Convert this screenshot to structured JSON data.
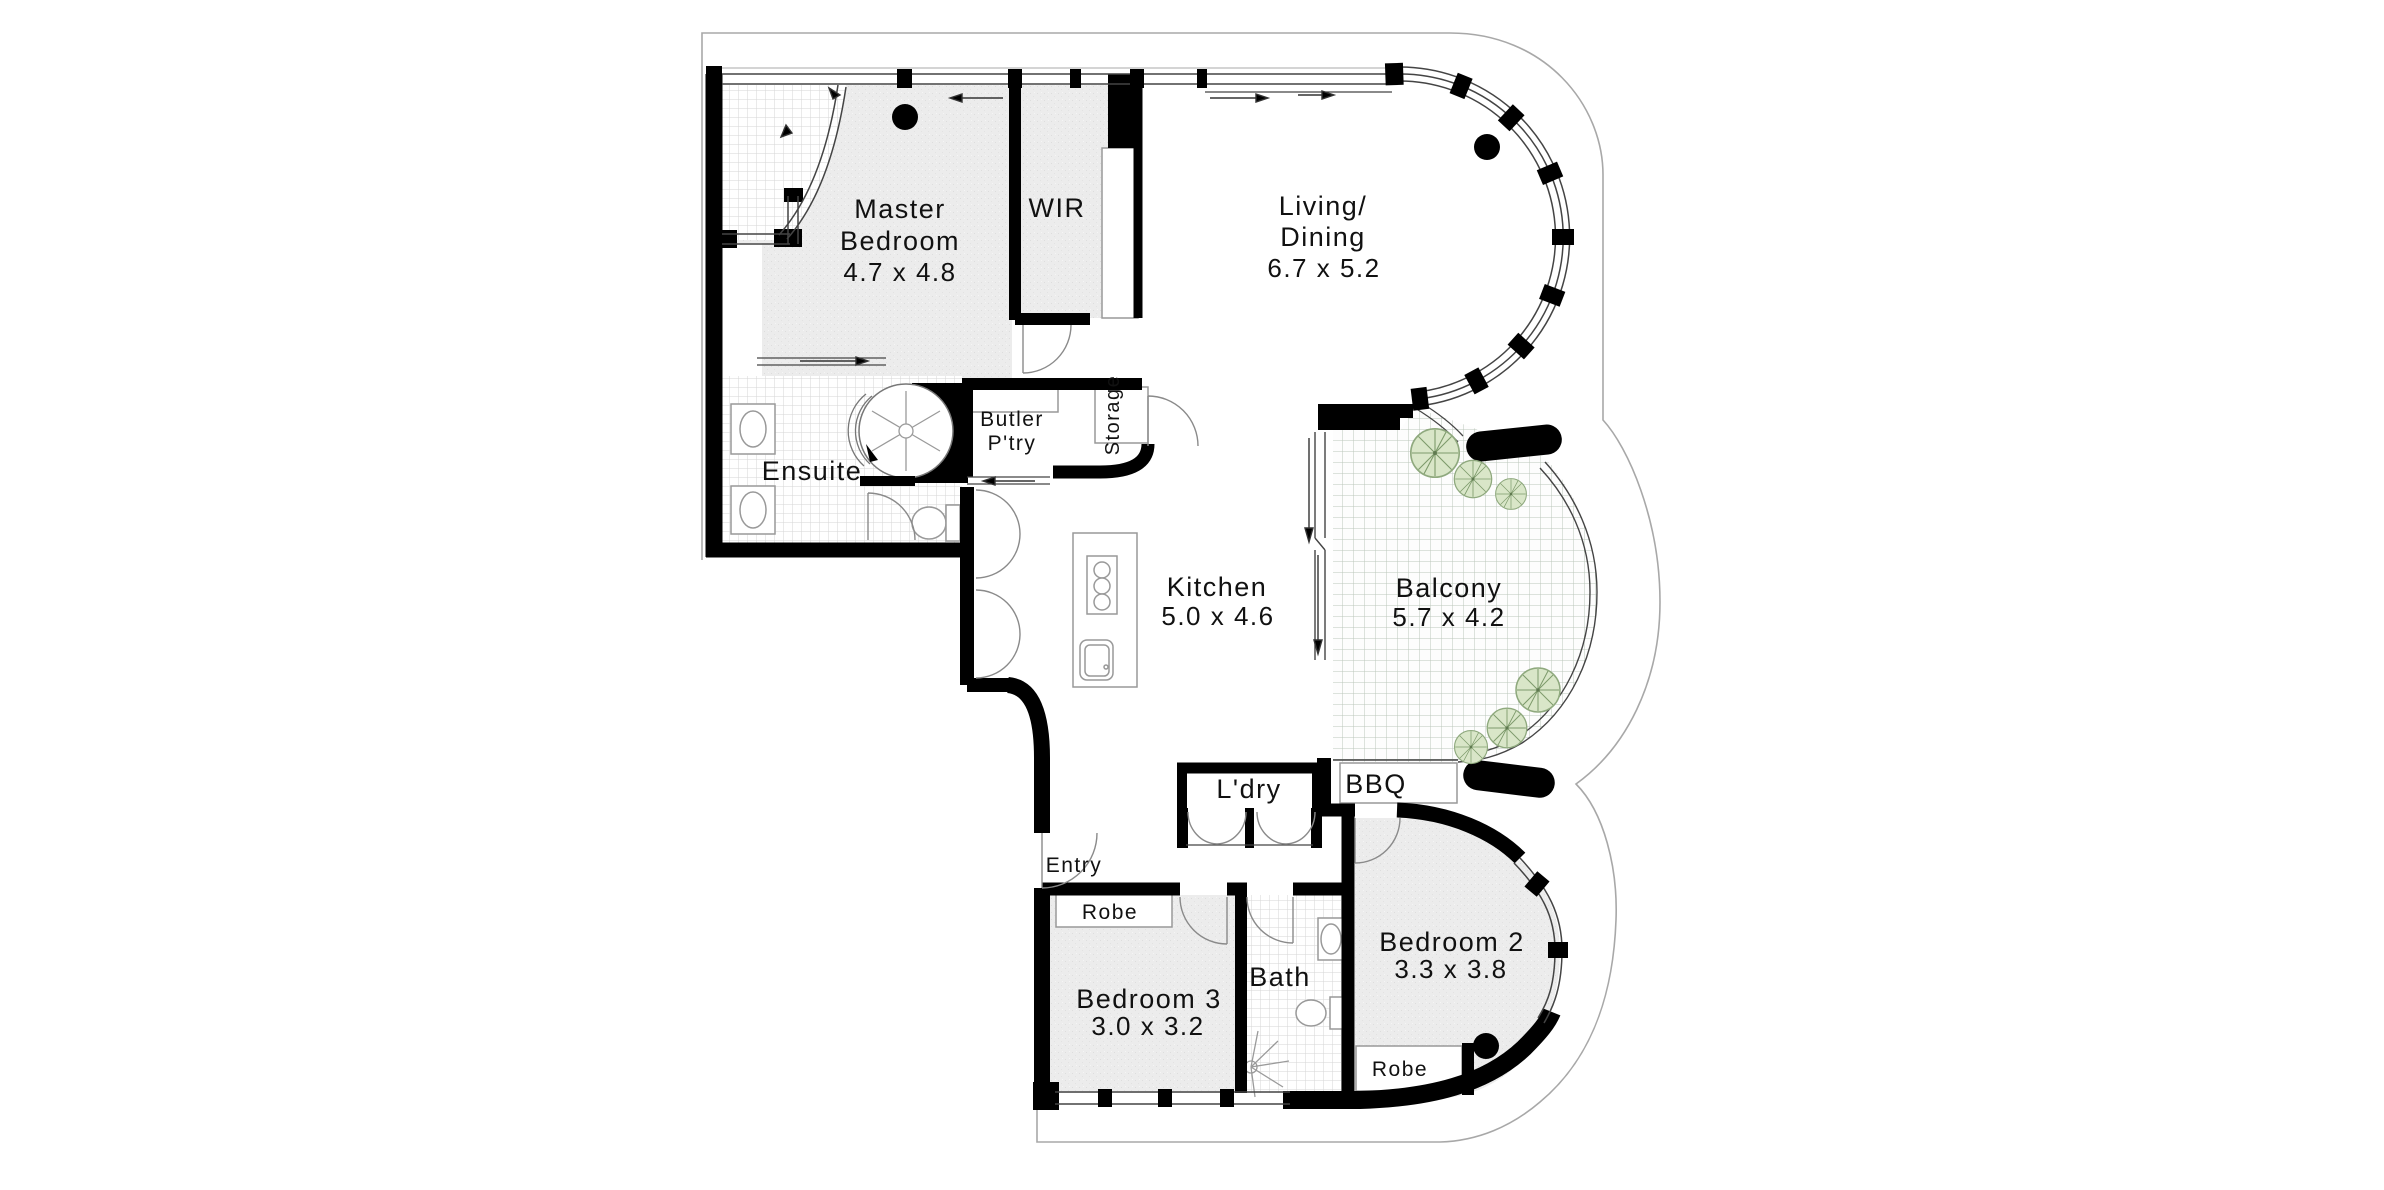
{
  "plan": {
    "type": "apartment-floor-plan",
    "labels": {
      "master_l1": "Master",
      "master_l2": "Bedroom",
      "master_dims": "4.7 x 4.8",
      "wir": "WIR",
      "living_l1": "Living/",
      "living_l2": "Dining",
      "living_dims": "6.7 x 5.2",
      "ensuite": "Ensuite",
      "butler_l1": "Butler",
      "butler_l2": "P'try",
      "storage": "Storage",
      "kitchen": "Kitchen",
      "kitchen_dims": "5.0 x 4.6",
      "balcony": "Balcony",
      "balcony_dims": "5.7 x 4.2",
      "laundry": "L'dry",
      "bbq": "BBQ",
      "entry": "Entry",
      "robe_bed3": "Robe",
      "bedroom3": "Bedroom 3",
      "bedroom3_dims": "3.0 x 3.2",
      "bath": "Bath",
      "bedroom2": "Bedroom 2",
      "bedroom2_dims": "3.3 x 3.8",
      "robe_bed2": "Robe"
    },
    "colors": {
      "wall": "#000000",
      "floor_shade": "#ebebeb",
      "tile_line": "#d6d6d6",
      "balcony_tile_line": "#bcc6ba",
      "plant_fill": "#d9e6c8",
      "plant_stroke": "#8fa97e",
      "outline": "#a8a8a8",
      "text": "#111111"
    }
  }
}
